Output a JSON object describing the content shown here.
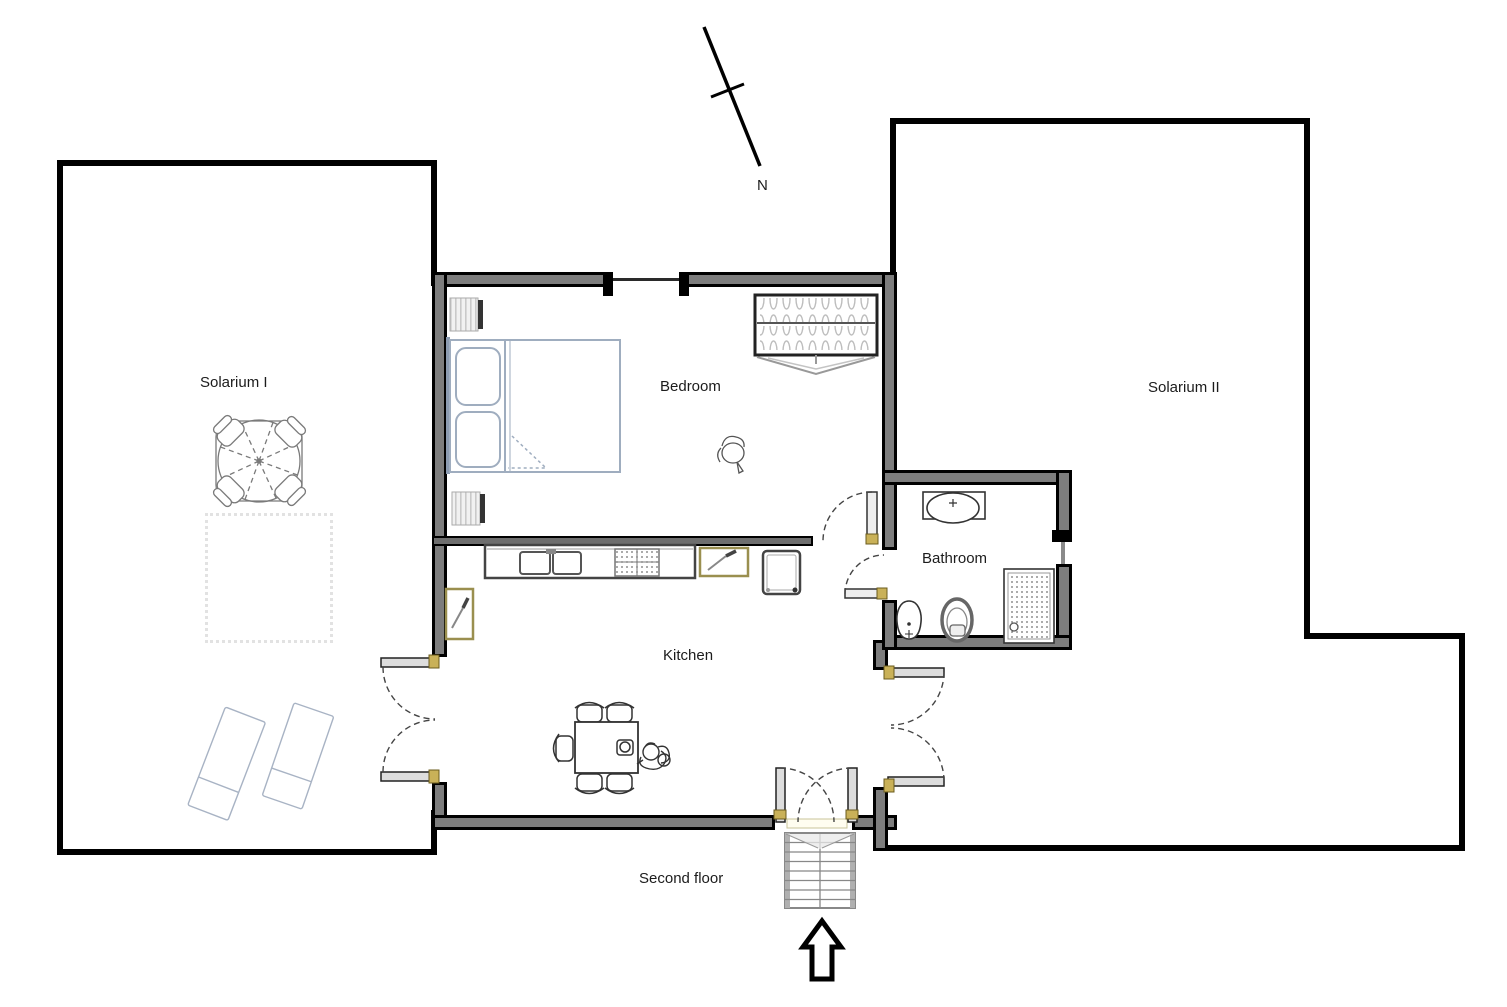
{
  "compass": {
    "label": "N"
  },
  "floor_label": "Second floor",
  "rooms": {
    "solarium_1": {
      "label": "Solarium I"
    },
    "bedroom": {
      "label": "Bedroom"
    },
    "solarium_2": {
      "label": "Solarium II"
    },
    "bathroom": {
      "label": "Bathroom"
    },
    "kitchen": {
      "label": "Kitchen"
    }
  },
  "fixtures": {
    "solarium_1": [
      "patio-table-with-parasol",
      "patio-chairs",
      "rug",
      "sun-lounger",
      "sun-lounger"
    ],
    "bedroom": [
      "double-bed",
      "nightstand",
      "nightstand",
      "wardrobe",
      "plant"
    ],
    "bathroom": [
      "washbasin",
      "bidet",
      "toilet",
      "shower"
    ],
    "kitchen": [
      "counter",
      "double-sink",
      "hob",
      "cutting-board",
      "cutting-board",
      "refrigerator",
      "dining-table",
      "chairs",
      "seated-person"
    ],
    "exterior": [
      "staircase",
      "up-arrow",
      "north-arrow",
      "double-doors"
    ]
  },
  "colors": {
    "wall": "#000000",
    "wall_core": "#7d7d7d",
    "sketch_blue": "#a8b3c4",
    "line_dark": "#333333",
    "hinge": "#c9b158"
  }
}
